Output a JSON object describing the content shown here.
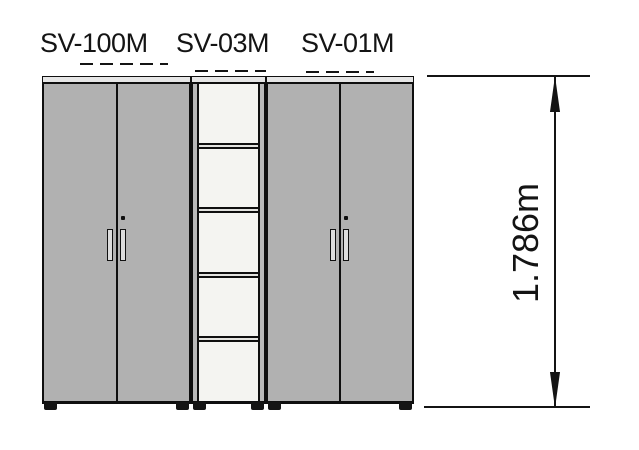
{
  "drawing": {
    "type": "furniture-elevation-diagram",
    "units": [
      {
        "id": "sv-100m",
        "label": "SV-100M",
        "kind": "double-door-cabinet"
      },
      {
        "id": "sv-03m",
        "label": "SV-03M",
        "kind": "open-shelf-unit",
        "shelf_count": 5
      },
      {
        "id": "sv-01m",
        "label": "SV-01M",
        "kind": "double-door-cabinet"
      }
    ],
    "dimension": {
      "label": "1.786m",
      "axis": "height"
    },
    "colors": {
      "cabinet_gray": "#b1b1b1",
      "shelf_white": "#f4f4f1",
      "top_rail_gray": "#e6e6e6",
      "outline": "#0f0f0f",
      "background": "#ffffff"
    }
  }
}
